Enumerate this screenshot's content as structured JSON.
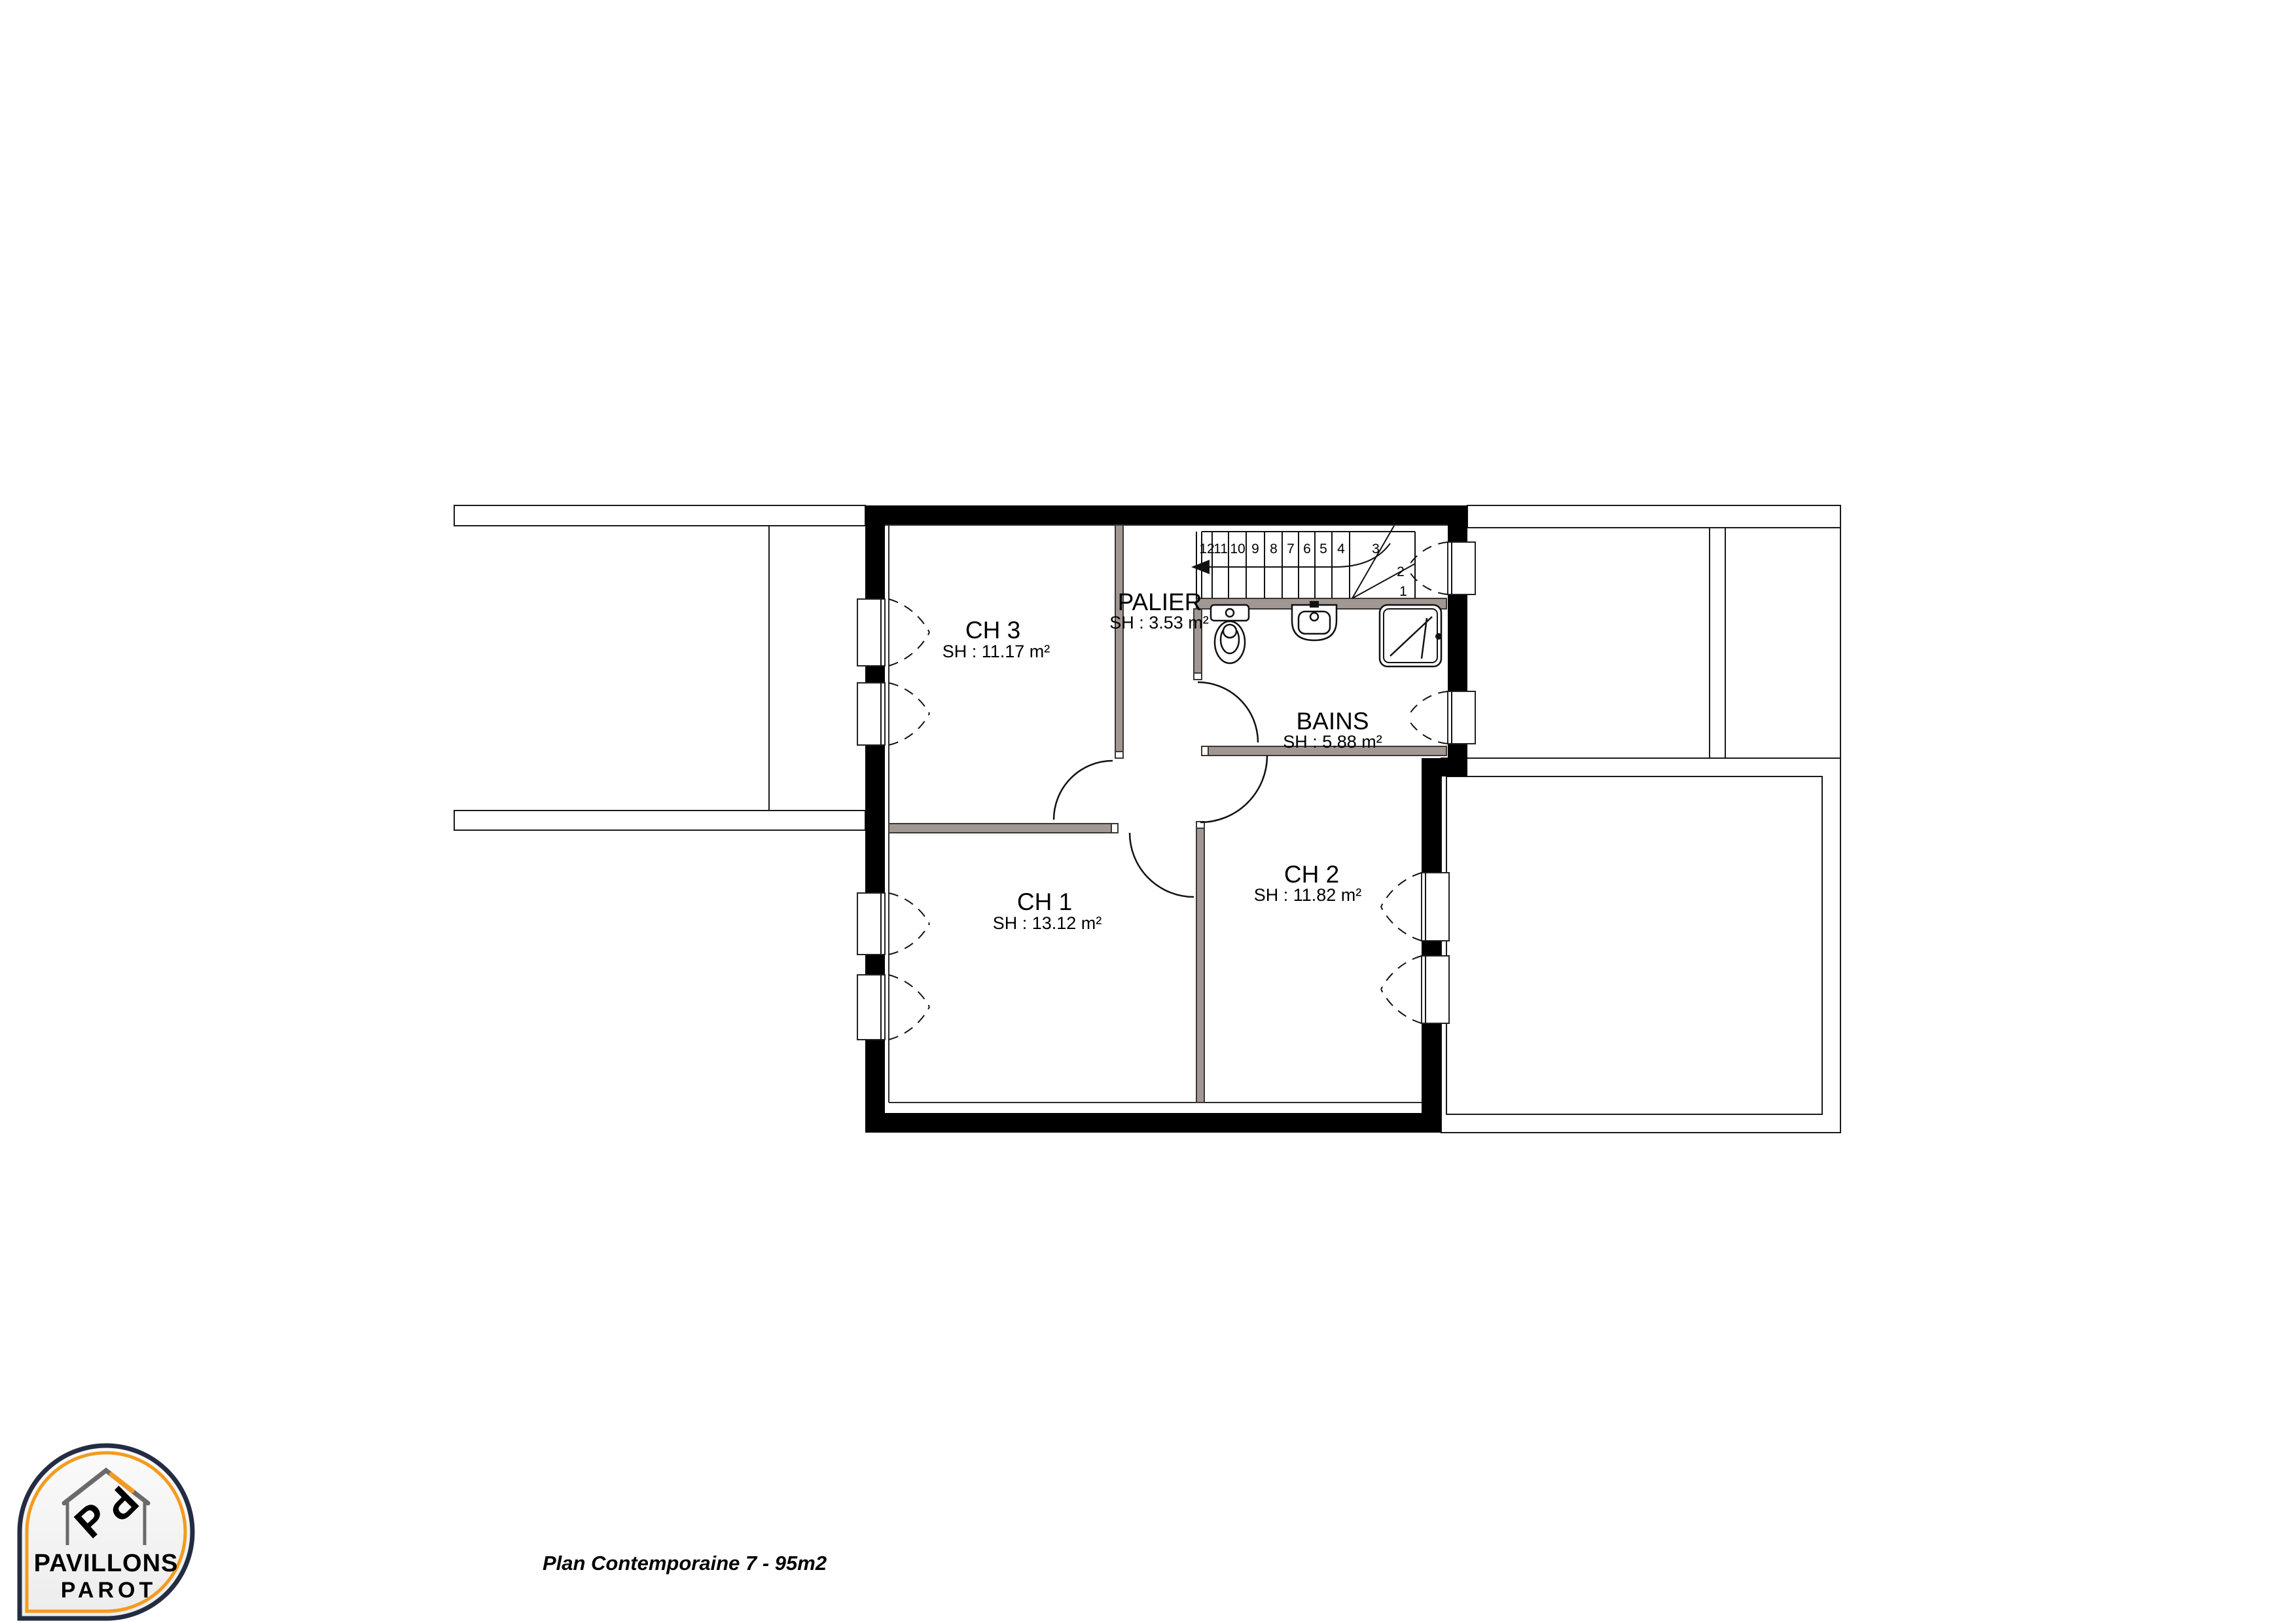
{
  "plan": {
    "title_hint": "floor plan - upper storey",
    "rooms": [
      {
        "id": "ch3",
        "name": "CH 3",
        "area_label": "SH : 11.17 m²"
      },
      {
        "id": "palier",
        "name": "PALIER",
        "area_label": "SH : 3.53 m²"
      },
      {
        "id": "bains",
        "name": "BAINS",
        "area_label": "SH : 5.88 m²"
      },
      {
        "id": "ch1",
        "name": "CH 1",
        "area_label": "SH : 13.12 m²"
      },
      {
        "id": "ch2",
        "name": "CH 2",
        "area_label": "SH : 11.82 m²"
      }
    ],
    "stairs": {
      "step_numbers": [
        "12",
        "11",
        "10",
        "9",
        "8",
        "7",
        "6",
        "5",
        "4",
        "3",
        "2",
        "1"
      ]
    }
  },
  "footer": {
    "caption": "Plan Contemporaine 7 - 95m2"
  },
  "logo": {
    "brand_top": "PAVILLONS",
    "brand_bottom": "PAROT",
    "monogram_letter": "P"
  },
  "colors": {
    "wall": "#000000",
    "partition": "#a29893",
    "brand_navy": "#232c42",
    "brand_orange": "#f49b1f",
    "brand_gray": "#6a6a6a",
    "paper": "#ffffff"
  }
}
